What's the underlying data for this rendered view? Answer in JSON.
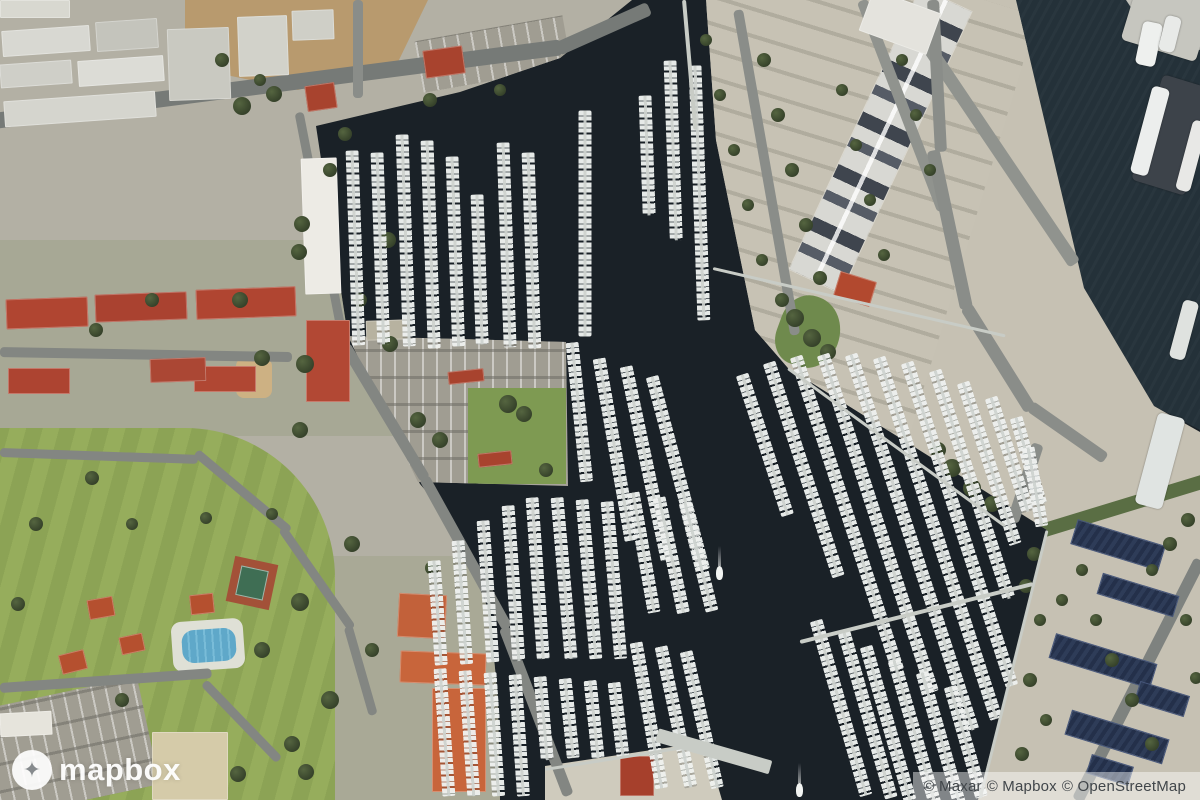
{
  "watermark": {
    "logo_text": "mapbox",
    "logo_icon": "mapbox-star-icon"
  },
  "attribution": {
    "full_text": "© Maxar © Mapbox © OpenStreetMap",
    "maxar": "© Maxar",
    "mapbox": "© Mapbox",
    "osm": "© OpenStreetMap"
  },
  "colors": {
    "water": "#1a2127",
    "channel": "#243139",
    "land_west": "#b3b0a4",
    "land_mid": "#c6c1b3",
    "land_strip": "#cfcbbd",
    "field": "#8ca355",
    "field_stripe": "#96ad5c",
    "dirt": "#b89a6e",
    "residential": "#9aa083",
    "roof_red": "#b04531",
    "roof_orange": "#c8653b",
    "pool": "#5fa8c9",
    "panel": "#24304a",
    "dock_boats": "#eef0ee",
    "road": "#83868b"
  },
  "scene": {
    "docks": [
      [
        352,
        150,
        195,
        88
      ],
      [
        377,
        152,
        192,
        88
      ],
      [
        402,
        134,
        212,
        88
      ],
      [
        427,
        140,
        208,
        88
      ],
      [
        452,
        156,
        190,
        88
      ],
      [
        477,
        194,
        150,
        88
      ],
      [
        503,
        142,
        205,
        88
      ],
      [
        528,
        152,
        196,
        88
      ],
      [
        585,
        110,
        226,
        90
      ],
      [
        645,
        95,
        120,
        88
      ],
      [
        670,
        60,
        180,
        88
      ],
      [
        695,
        65,
        255,
        88
      ],
      [
        572,
        342,
        140,
        84
      ],
      [
        599,
        358,
        185,
        80
      ],
      [
        626,
        366,
        198,
        78
      ],
      [
        652,
        376,
        200,
        75
      ],
      [
        434,
        560,
        105,
        86
      ],
      [
        458,
        540,
        124,
        86
      ],
      [
        483,
        520,
        142,
        86
      ],
      [
        508,
        505,
        156,
        86
      ],
      [
        532,
        497,
        162,
        86
      ],
      [
        557,
        497,
        162,
        85
      ],
      [
        582,
        499,
        160,
        85
      ],
      [
        607,
        501,
        158,
        85
      ],
      [
        440,
        668,
        128,
        86
      ],
      [
        465,
        670,
        126,
        86
      ],
      [
        490,
        672,
        124,
        86
      ],
      [
        515,
        674,
        122,
        86
      ],
      [
        540,
        676,
        84,
        85
      ],
      [
        565,
        678,
        80,
        84
      ],
      [
        590,
        680,
        78,
        84
      ],
      [
        614,
        682,
        74,
        83
      ],
      [
        633,
        492,
        122,
        80
      ],
      [
        659,
        497,
        118,
        78
      ],
      [
        685,
        502,
        112,
        76
      ],
      [
        636,
        642,
        148,
        80
      ],
      [
        661,
        646,
        144,
        78
      ],
      [
        686,
        651,
        140,
        77
      ],
      [
        742,
        374,
        148,
        72
      ],
      [
        769,
        362,
        225,
        72
      ],
      [
        796,
        356,
        330,
        72
      ],
      [
        823,
        354,
        355,
        72
      ],
      [
        851,
        354,
        395,
        72
      ],
      [
        879,
        357,
        380,
        72
      ],
      [
        907,
        362,
        340,
        72
      ],
      [
        935,
        370,
        240,
        72
      ],
      [
        963,
        382,
        170,
        72
      ],
      [
        991,
        397,
        120,
        72
      ],
      [
        1016,
        417,
        90,
        74
      ],
      [
        1028,
        447,
        80,
        80
      ],
      [
        816,
        620,
        182,
        74
      ],
      [
        844,
        632,
        172,
        74
      ],
      [
        866,
        646,
        160,
        74
      ],
      [
        894,
        660,
        150,
        74
      ],
      [
        922,
        672,
        140,
        74
      ],
      [
        950,
        686,
        115,
        74
      ]
    ],
    "piers": [
      [
        800,
        642,
        240,
        4,
        -14
      ],
      [
        713,
        268,
        300,
        3,
        13
      ],
      [
        657,
        735,
        118,
        14,
        16
      ],
      [
        788,
        368,
        268,
        3,
        36
      ],
      [
        1047,
        530,
        276,
        3,
        104
      ],
      [
        545,
        769,
        162,
        3,
        -9
      ],
      [
        684,
        0,
        130,
        4,
        85
      ]
    ],
    "roads": [
      [
        -6,
        121,
        572,
        16,
        -7.4,
        "#767a77"
      ],
      [
        558,
        49,
        100,
        14,
        -24,
        "#767a77"
      ],
      [
        358,
        0,
        98,
        10,
        90,
        "#8a8d89"
      ],
      [
        299,
        112,
        240,
        9,
        79,
        "#838682"
      ],
      [
        345,
        345,
        156,
        11,
        59,
        "#838682"
      ],
      [
        424,
        477,
        172,
        11,
        61,
        "#838682"
      ],
      [
        504,
        627,
        180,
        11,
        69,
        "#838682"
      ],
      [
        0,
        352,
        292,
        10,
        1,
        "#838682"
      ],
      [
        0,
        452,
        198,
        9,
        2,
        "#838682"
      ],
      [
        196,
        452,
        122,
        9,
        40,
        "#838682"
      ],
      [
        282,
        528,
        122,
        9,
        55,
        "#838682"
      ],
      [
        348,
        626,
        92,
        9,
        74,
        "#838682"
      ],
      [
        0,
        688,
        212,
        10,
        -4,
        "#838682"
      ],
      [
        204,
        682,
        108,
        9,
        46,
        "#838682"
      ],
      [
        738,
        10,
        330,
        10,
        80,
        "#8a8d89"
      ],
      [
        862,
        0,
        225,
        11,
        69,
        "#90938e"
      ],
      [
        897,
        0,
        318,
        13,
        56,
        "#90938e"
      ],
      [
        933,
        0,
        152,
        12,
        87,
        "#8a8d89"
      ],
      [
        933,
        150,
        162,
        13,
        78,
        "#8a8d89"
      ],
      [
        966,
        306,
        122,
        13,
        58,
        "#8a8d89"
      ],
      [
        1030,
        406,
        92,
        12,
        35,
        "#8a8d89"
      ],
      [
        1038,
        444,
        82,
        12,
        108,
        "#8a8d89"
      ],
      [
        1200,
        560,
        270,
        12,
        117,
        "#7e827f"
      ]
    ],
    "buildings": [
      [
        2,
        28,
        88,
        26,
        "#d8d8d2",
        -4
      ],
      [
        96,
        20,
        62,
        30,
        "#c4c4bc",
        -4
      ],
      [
        0,
        62,
        72,
        24,
        "#cfcfc8",
        -4
      ],
      [
        78,
        58,
        86,
        26,
        "#dcdcd6",
        -4
      ],
      [
        4,
        96,
        152,
        26,
        "#d5d5ce",
        -4
      ],
      [
        168,
        28,
        62,
        72,
        "#c9c9c1",
        -2
      ],
      [
        238,
        16,
        50,
        60,
        "#d2d2ca",
        -2
      ],
      [
        292,
        10,
        42,
        30,
        "#cfcfc7",
        -2
      ],
      [
        0,
        0,
        70,
        18,
        "#d8d8d0",
        0
      ],
      [
        303,
        158,
        36,
        136,
        "#edebe5",
        -2
      ],
      [
        6,
        298,
        82,
        30,
        "#b04531",
        -2
      ],
      [
        95,
        293,
        92,
        28,
        "#aa4230",
        -2
      ],
      [
        196,
        288,
        100,
        30,
        "#b04531",
        -2
      ],
      [
        8,
        368,
        62,
        26,
        "#ad4431",
        0
      ],
      [
        194,
        366,
        62,
        26,
        "#b04733",
        0
      ],
      [
        306,
        320,
        44,
        82,
        "#b24834",
        0
      ],
      [
        150,
        358,
        56,
        24,
        "#ab4734",
        -2
      ],
      [
        424,
        48,
        40,
        28,
        "#a8432e",
        -8
      ],
      [
        306,
        84,
        30,
        26,
        "#a8432e",
        -8
      ],
      [
        88,
        598,
        26,
        20,
        "#b5502f",
        -10
      ],
      [
        60,
        652,
        26,
        20,
        "#b5502f",
        -14
      ],
      [
        120,
        635,
        24,
        18,
        "#b5502f",
        -12
      ],
      [
        190,
        594,
        24,
        20,
        "#b5502f",
        -6
      ],
      [
        448,
        370,
        36,
        13,
        "#a8432e",
        -6
      ],
      [
        478,
        452,
        34,
        14,
        "#a8432e",
        -6
      ],
      [
        398,
        594,
        48,
        44,
        "#c2613a",
        3
      ],
      [
        400,
        652,
        86,
        32,
        "#c8653b",
        2
      ],
      [
        432,
        688,
        54,
        104,
        "#c8653b",
        0
      ],
      [
        620,
        756,
        34,
        40,
        "#a6402c",
        0
      ],
      [
        152,
        732,
        76,
        68,
        "#d5cba9",
        0
      ],
      [
        0,
        712,
        52,
        24,
        "#e6e4dc",
        -3
      ],
      [
        864,
        0,
        72,
        44,
        "#e4e3dd",
        20
      ],
      [
        836,
        276,
        38,
        26,
        "#b2492f",
        17
      ],
      [
        366,
        320,
        44,
        20,
        "#b7b2a0",
        -2
      ]
    ],
    "panels": [
      [
        1072,
        532,
        92,
        26
      ],
      [
        1098,
        584,
        80,
        22
      ],
      [
        1050,
        648,
        106,
        26
      ],
      [
        1066,
        724,
        102,
        26
      ],
      [
        1136,
        688,
        52,
        22
      ],
      [
        1088,
        760,
        44,
        20
      ]
    ],
    "ships": [
      [
        1128,
        -10,
        78,
        62,
        17,
        "#c6c6bf"
      ],
      [
        1139,
        22,
        20,
        44,
        12,
        "#eef0ee"
      ],
      [
        1162,
        16,
        16,
        36,
        14,
        "#e8eae8"
      ],
      [
        1146,
        80,
        56,
        110,
        17,
        "#3d434a"
      ],
      [
        1141,
        86,
        18,
        90,
        15,
        "#eceeed"
      ],
      [
        1184,
        120,
        15,
        72,
        15,
        "#e8e8e6"
      ],
      [
        1146,
        414,
        28,
        94,
        15,
        "#e0e4e2"
      ],
      [
        1176,
        300,
        16,
        60,
        15,
        "#dfe2df"
      ]
    ],
    "trees": [
      [
        242,
        106,
        9
      ],
      [
        274,
        94,
        8
      ],
      [
        345,
        134,
        7
      ],
      [
        302,
        224,
        8
      ],
      [
        299,
        252,
        8
      ],
      [
        388,
        240,
        8
      ],
      [
        152,
        300,
        7
      ],
      [
        240,
        300,
        8
      ],
      [
        96,
        330,
        7
      ],
      [
        262,
        358,
        8
      ],
      [
        305,
        364,
        9
      ],
      [
        390,
        344,
        8
      ],
      [
        300,
        430,
        8
      ],
      [
        352,
        544,
        8
      ],
      [
        300,
        602,
        9
      ],
      [
        262,
        650,
        8
      ],
      [
        330,
        700,
        9
      ],
      [
        292,
        744,
        8
      ],
      [
        372,
        650,
        7
      ],
      [
        432,
        568,
        7
      ],
      [
        92,
        478,
        7
      ],
      [
        36,
        524,
        7
      ],
      [
        132,
        524,
        6
      ],
      [
        206,
        518,
        6
      ],
      [
        272,
        514,
        6
      ],
      [
        18,
        604,
        7
      ],
      [
        122,
        700,
        7
      ],
      [
        238,
        774,
        8
      ],
      [
        306,
        772,
        8
      ],
      [
        418,
        420,
        8
      ],
      [
        440,
        440,
        8
      ],
      [
        508,
        404,
        9
      ],
      [
        524,
        414,
        8
      ],
      [
        546,
        470,
        7
      ],
      [
        360,
        300,
        7
      ],
      [
        330,
        170,
        7
      ],
      [
        430,
        100,
        7
      ],
      [
        500,
        90,
        6
      ],
      [
        222,
        60,
        7
      ],
      [
        260,
        80,
        6
      ],
      [
        706,
        40,
        6
      ],
      [
        720,
        95,
        6
      ],
      [
        734,
        150,
        6
      ],
      [
        748,
        205,
        6
      ],
      [
        762,
        260,
        6
      ],
      [
        764,
        60,
        7
      ],
      [
        778,
        115,
        7
      ],
      [
        792,
        170,
        7
      ],
      [
        806,
        225,
        7
      ],
      [
        820,
        278,
        7
      ],
      [
        842,
        90,
        6
      ],
      [
        856,
        145,
        6
      ],
      [
        870,
        200,
        6
      ],
      [
        884,
        255,
        6
      ],
      [
        902,
        60,
        6
      ],
      [
        916,
        115,
        6
      ],
      [
        930,
        170,
        6
      ],
      [
        795,
        318,
        9
      ],
      [
        812,
        338,
        9
      ],
      [
        828,
        352,
        8
      ],
      [
        782,
        300,
        7
      ],
      [
        952,
        468,
        9
      ],
      [
        972,
        488,
        9
      ],
      [
        992,
        504,
        8
      ],
      [
        938,
        450,
        8
      ],
      [
        1034,
        554,
        7
      ],
      [
        1026,
        586,
        7
      ],
      [
        1040,
        620,
        6
      ],
      [
        1030,
        680,
        7
      ],
      [
        1046,
        720,
        6
      ],
      [
        1022,
        754,
        7
      ],
      [
        1062,
        600,
        6
      ],
      [
        1082,
        570,
        6
      ],
      [
        1188,
        520,
        7
      ],
      [
        1170,
        544,
        7
      ],
      [
        1152,
        570,
        6
      ],
      [
        1186,
        620,
        6
      ],
      [
        1196,
        678,
        6
      ],
      [
        1112,
        660,
        7
      ],
      [
        1132,
        700,
        7
      ],
      [
        1152,
        744,
        7
      ],
      [
        1096,
        620,
        6
      ]
    ],
    "boats_moving": [
      [
        716,
        566
      ],
      [
        796,
        783
      ]
    ]
  }
}
